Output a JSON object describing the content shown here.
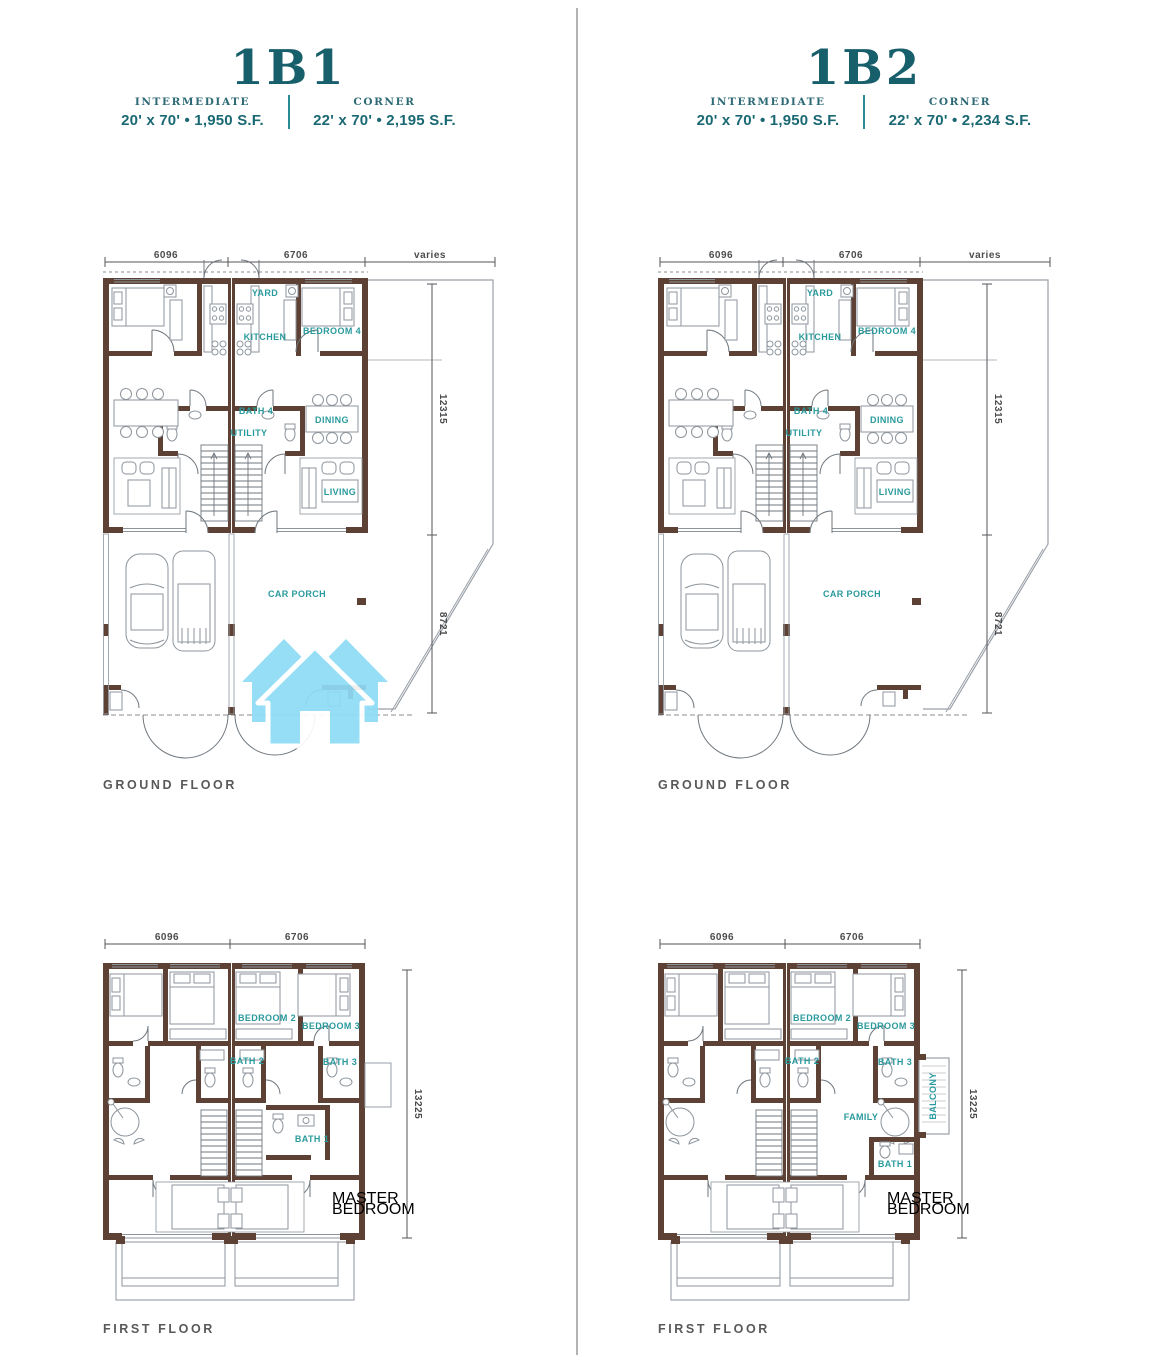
{
  "page": {
    "background": "#ffffff",
    "divider_color": "#b3b3b3"
  },
  "colors": {
    "title_teal": "#185f6c",
    "spec_teal": "#1a6873",
    "room_label_teal": "#2a9a9d",
    "wall_brown": "#5d4134",
    "dimension_gray": "#4b4c4e",
    "caption_gray": "#58595b",
    "furniture_gray": "#8d959c",
    "watermark_blue": "#8edcf5"
  },
  "plan_labels": {
    "ground": {
      "yard": "YARD",
      "kitchen": "KITCHEN",
      "bedroom4": "BEDROOM 4",
      "bath4": "BATH 4",
      "utility": "UTILITY",
      "dining": "DINING",
      "living": "LIVING",
      "car_porch": "CAR PORCH",
      "dims": {
        "width_left": "6096",
        "width_mid": "6706",
        "width_right": "varies",
        "depth_upper": "12315",
        "depth_lower": "8721"
      }
    },
    "first": {
      "bedroom2": "BEDROOM 2",
      "bedroom3": "BEDROOM 3",
      "bath2": "BATH 2",
      "bath3": "BATH 3",
      "bath1": "BATH 1",
      "master_line1": "MASTER",
      "master_line2": "BEDROOM",
      "family": "FAMILY",
      "balcony": "BALCONY",
      "dims": {
        "width_left": "6096",
        "width_mid": "6706",
        "depth": "13225"
      }
    }
  },
  "units": [
    {
      "title": "1B1",
      "specs": {
        "intermediate_label": "INTERMEDIATE",
        "intermediate_value": "20' x 70' • 1,950 S.F.",
        "corner_label": "CORNER",
        "corner_value": "22' x 70' • 2,195 S.F."
      },
      "ground_caption": "GROUND FLOOR",
      "first_caption": "FIRST FLOOR"
    },
    {
      "title": "1B2",
      "specs": {
        "intermediate_label": "INTERMEDIATE",
        "intermediate_value": "20' x 70' • 1,950 S.F.",
        "corner_label": "CORNER",
        "corner_value": "22' x 70' • 2,234 S.F."
      },
      "ground_caption": "GROUND FLOOR",
      "first_caption": "FIRST FLOOR"
    }
  ]
}
